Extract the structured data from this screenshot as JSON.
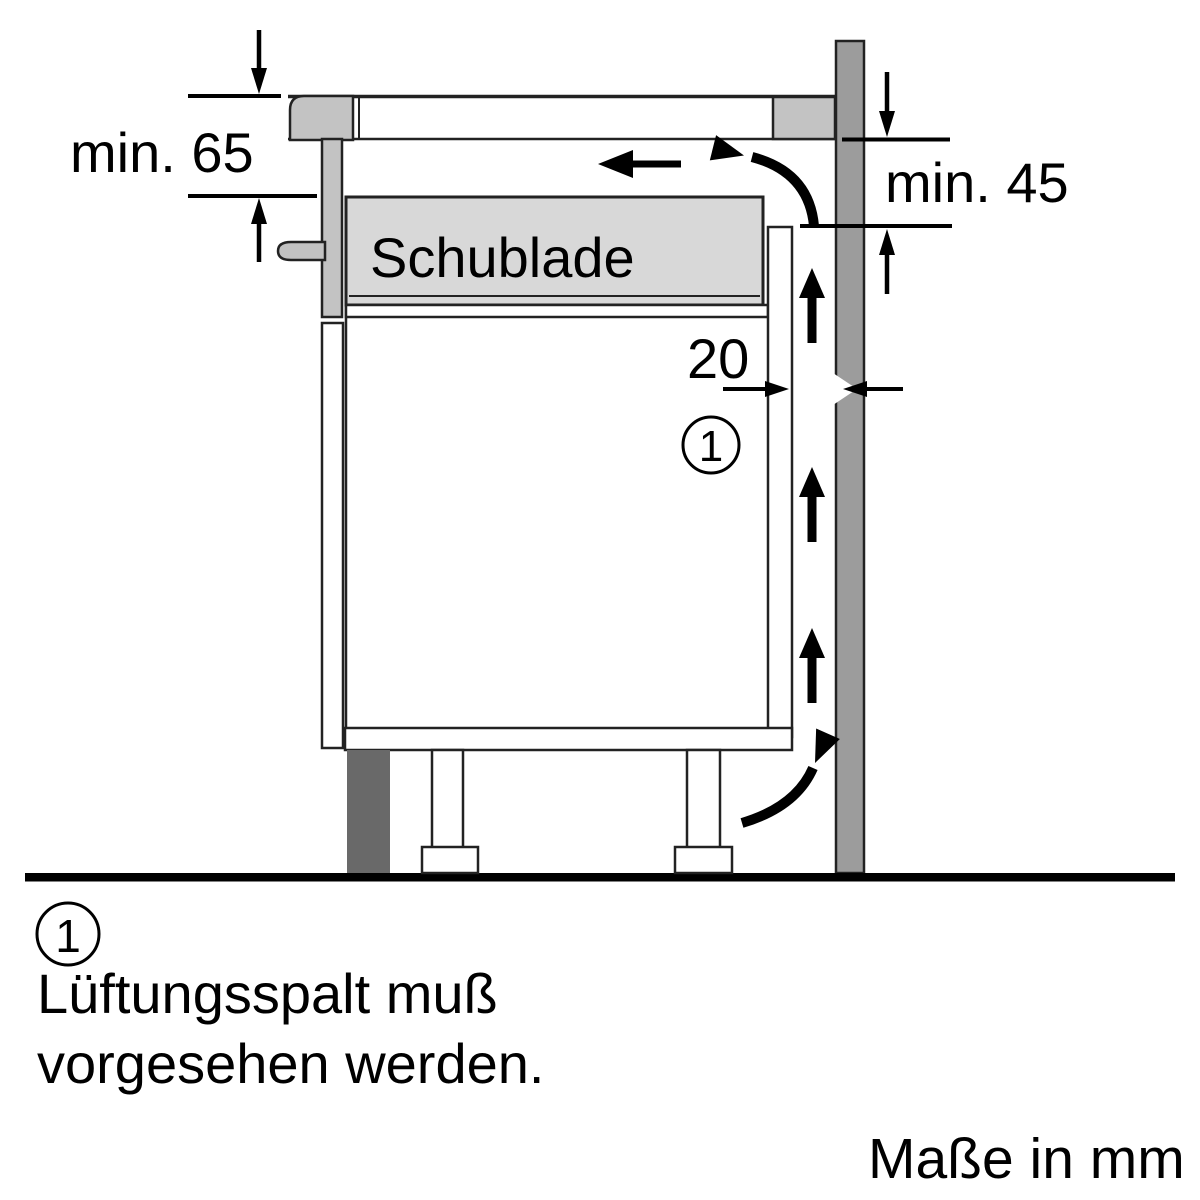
{
  "figure": {
    "type": "appliance-installation-diagram",
    "units_label": "Maße in mm"
  },
  "dimensions": {
    "top_clearance": "min. 65",
    "side_clearance": "min. 45",
    "vent_gap": "20"
  },
  "cabinet": {
    "drawer_label": "Schublade"
  },
  "callout": {
    "number": "1",
    "note_line1": "Lüftungsspalt muß",
    "note_line2": "vorgesehen werden."
  },
  "colors": {
    "ink": "#000000",
    "outline": "#222222",
    "hob_gray": "#c3c3c3",
    "drawer_gray": "#d8d8d8",
    "wall_gray": "#9c9c9c",
    "plinth_gray": "#696969",
    "handle_gray": "#c2c2c2",
    "white": "#ffffff"
  }
}
